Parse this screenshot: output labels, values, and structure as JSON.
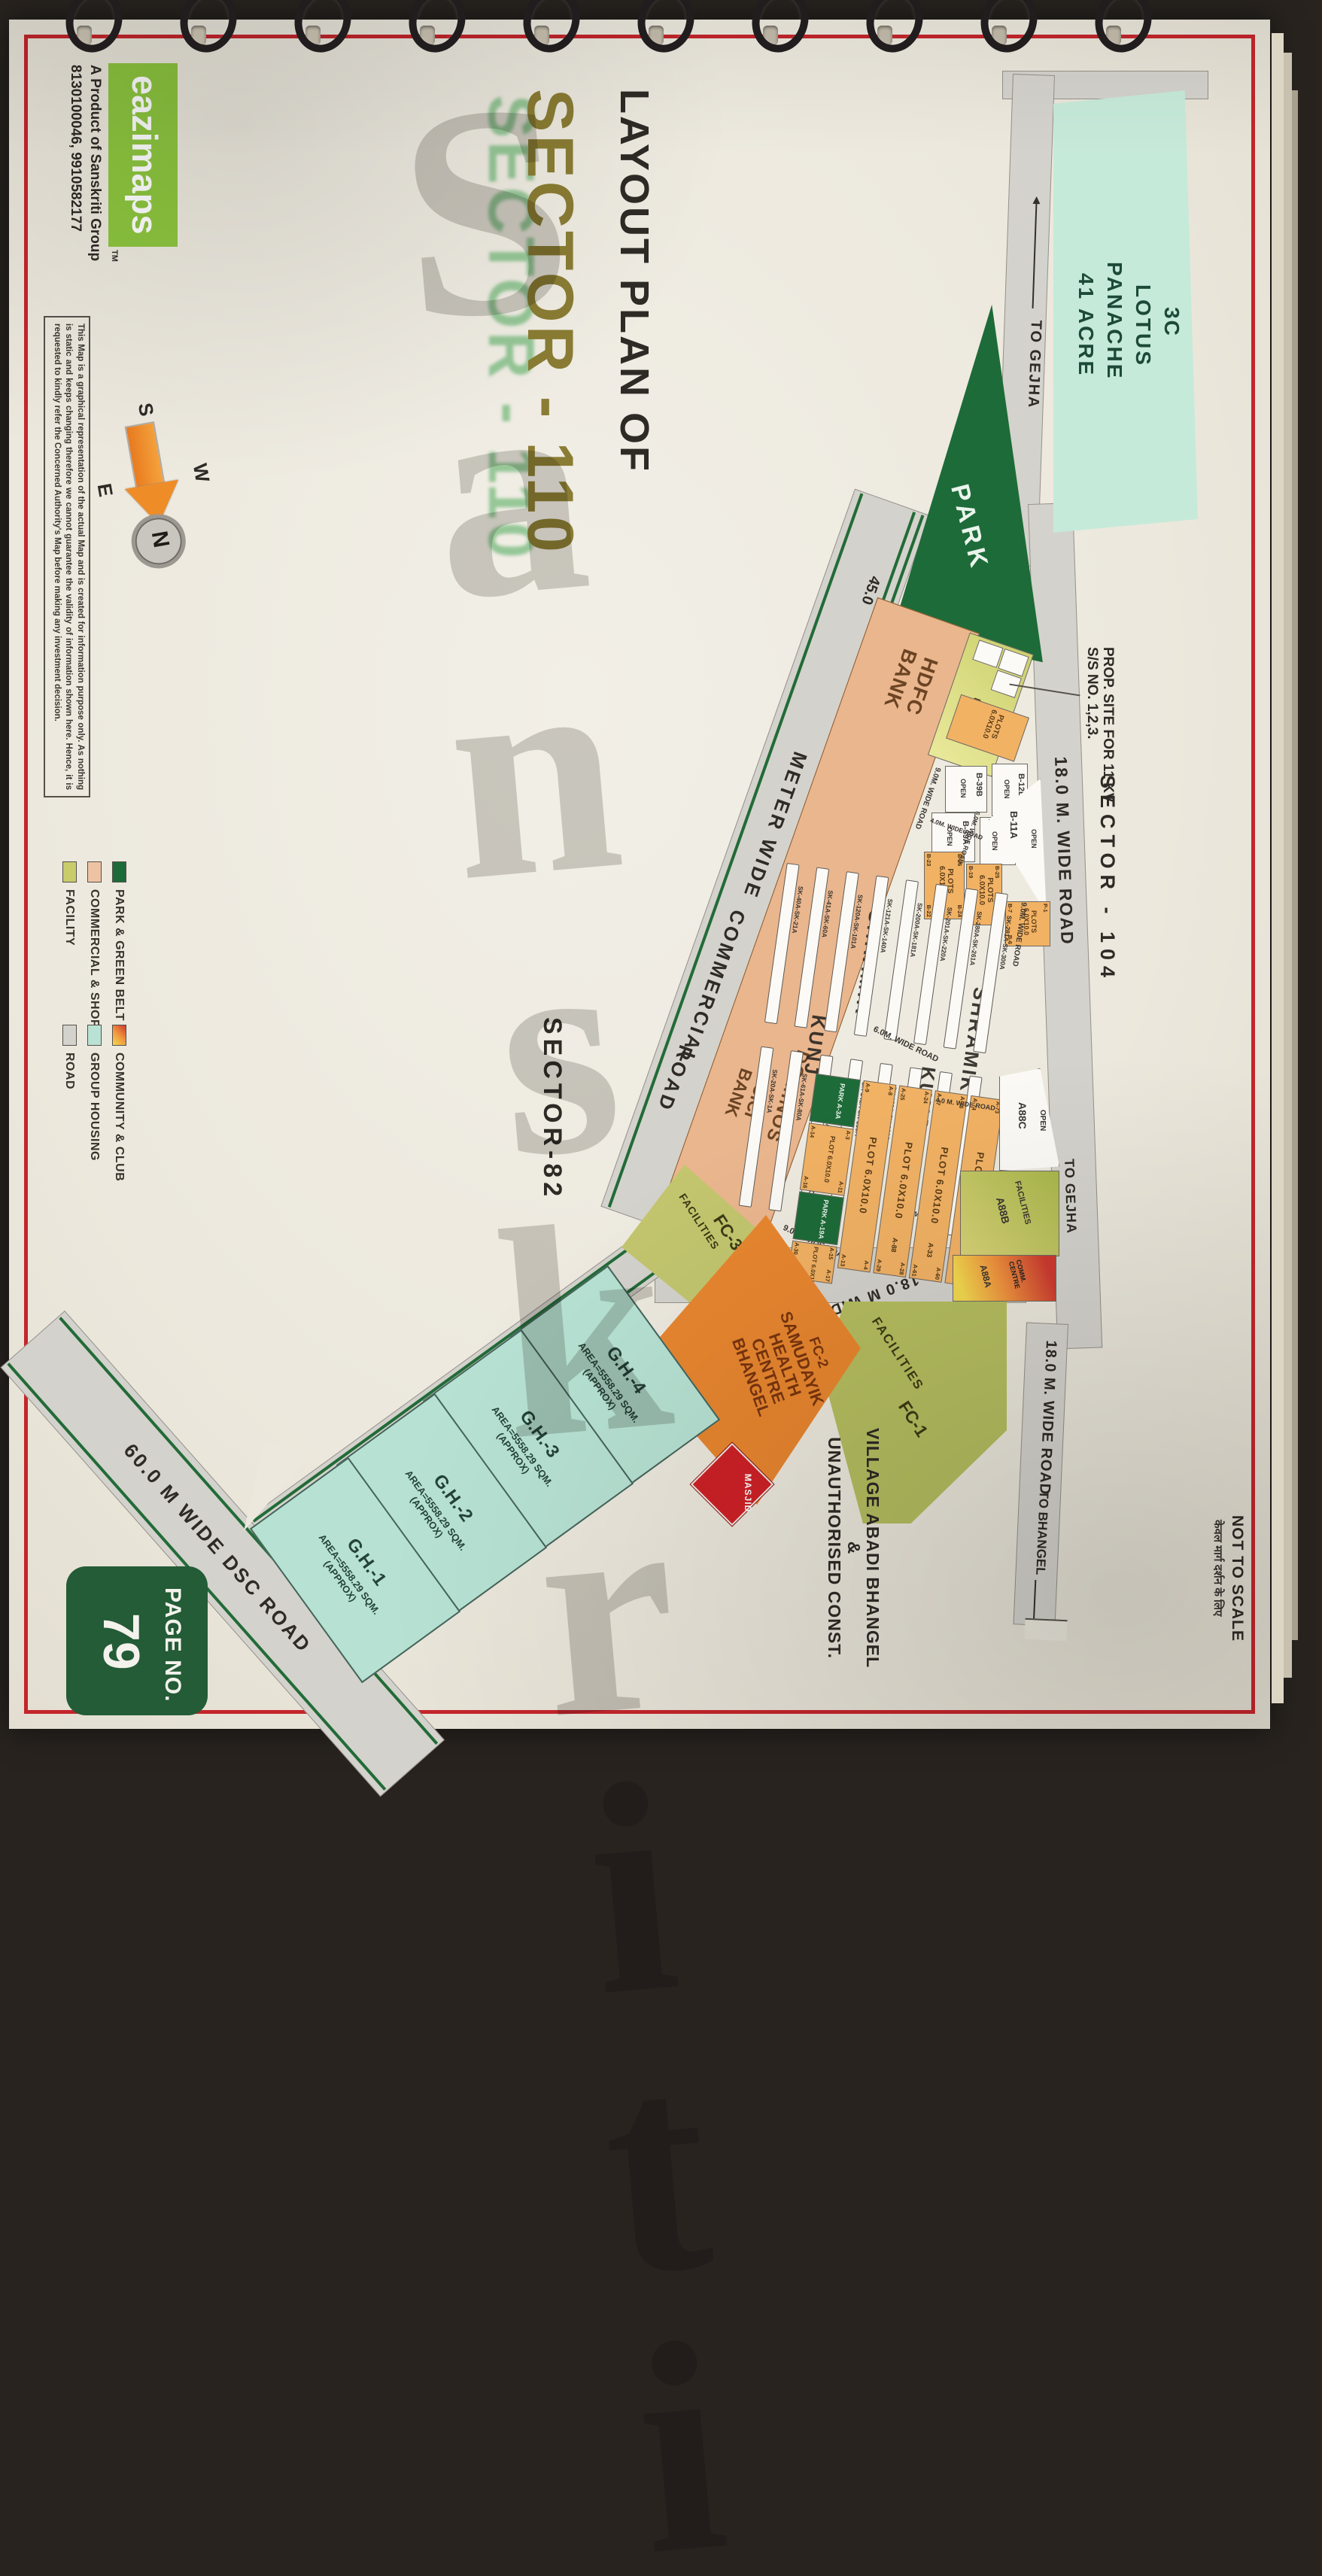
{
  "page_badge": {
    "label": "PAGE NO.",
    "number": "79"
  },
  "brand": {
    "logo": "eazimaps",
    "tm": "TM",
    "tagline": "A Product of Sanskriti Group",
    "phone": "8130100046, 9910582177",
    "logo_color": "#8dc63f"
  },
  "disclaimer": "This Map is a graphical representation of the actual Map and is created for information purpose only. As nothing is static and keeps changing therefore we cannot guarantee the validity of information shown here. Hence, it is requested to kindly refer the Concerned Authority's Map before making any investment decision.",
  "title": {
    "line1": "LAYOUT PLAN OF",
    "line2": "SECTOR - 110",
    "accent": "#8a7c33",
    "ghost": "#4aa857"
  },
  "watermark": "Sanskriti",
  "scale_note": {
    "en": "NOT TO SCALE",
    "hi": "केवल मार्ग दर्शन के लिए"
  },
  "compass": {
    "n": "N",
    "s": "S",
    "e": "E",
    "w": "W"
  },
  "legend": {
    "items": [
      {
        "label": "PARK & GREEN BELT",
        "color": "#1d6b38"
      },
      {
        "label": "COMMERCIAL & SHOPS",
        "color": "#eec3a4"
      },
      {
        "label": "FACILITY",
        "color": "#c9cc6b"
      },
      {
        "label": "COMMUNITY & CLUB",
        "color": "gradient:#cc3a30,#f0953e,#f3d94f"
      },
      {
        "label": "GROUP HOUSING",
        "color": "#b9e2d4"
      },
      {
        "label": "ROAD",
        "color": "#d4d2cc"
      }
    ]
  },
  "neighbors": {
    "lotus": {
      "l1": "3C",
      "l2": "LOTUS",
      "l3": "PANACHE",
      "l4": "41 ACRE"
    },
    "sector104": "SECTOR - 104",
    "sector82": "SECTOR-82",
    "prop_site": {
      "l1": "PROP. SITE FOR 11 KV",
      "l2": "S/S NO. 1,2,3."
    },
    "village": {
      "v1": "VILLAGE ABADI BHANGEL",
      "amp": "&",
      "v2": "UNAUTHORISED CONST."
    }
  },
  "roads": {
    "to_gejha_top": "TO GEJHA",
    "r18_upper": "18.0 M. WIDE ROAD",
    "to_gejha_right": "TO GEJHA",
    "r18_lower": "18.0 M. WIDE ROAD",
    "to_bhangel": "TO BHANGEL",
    "r45_num": "45.0",
    "r45_meter": "METER WIDE",
    "r45_comm": "COMMERCIAL",
    "r45_road": "ROAD",
    "r18_vert": "18.0 M WIDE ROAD",
    "dsc": "60.0 M WIDE DSC ROAD",
    "r9a": "9.0M. WIDE ROAD",
    "r9b": "9.0M. WIDE ROAD",
    "r9c": "9.0M WIDE ROAD",
    "r9d": "9.0M. WIDE ROAD",
    "r6a": "6.0M. WIDE ROAD",
    "r6b": "6.0M. WIDE ROAD",
    "r4a": "4.0M. WIDE ROAD",
    "r4b": "4.0M WIDE ROAD",
    "r4c": "4.0 M. WIDE ROAD"
  },
  "blocks": {
    "park": "PARK",
    "hdfc": {
      "l1": "HDFC",
      "l2": "BANK"
    },
    "dominos": "DOMINOS",
    "icici": {
      "l1": "ICICI",
      "l2": "BANK"
    },
    "fac": {
      "l1": "FAC.",
      "l2": "B-53A"
    },
    "plots53": {
      "l1": "PLOTS",
      "l2": "6.0X10.0"
    },
    "b12b": "B-12B",
    "b12c": "B-12C",
    "b39b": "B-39B",
    "b39a": "B-39A",
    "b11a": "B-11A",
    "open": "OPEN",
    "a88c": {
      "open": "OPEN",
      "name": "A88C"
    },
    "a88b": {
      "label": "FACILITIES",
      "name": "A88B"
    },
    "a88a": {
      "l1": "COMM.",
      "l2": "CENTRE",
      "name": "A88A"
    },
    "fc1": {
      "name": "FC-1",
      "label": "FACILITIES"
    },
    "fc3": {
      "name": "FC-3",
      "label": "FACILITIES"
    },
    "fc2": {
      "name": "FC-2",
      "l1": "SAMUDAYIK",
      "l2": "HEALTH",
      "l3": "CENTRE",
      "l4": "BHANGEL"
    },
    "masjid": "MASJID"
  },
  "plot_b": {
    "p1": {
      "c1": "PLOTS",
      "c2": "6.0X10.0",
      "tl": "B-26",
      "tr": "B-24",
      "bl": "B-23",
      "br": "B-22"
    },
    "p2": {
      "c1": "PLOTS",
      "c2": "6.0X10.0",
      "tl": "B-25",
      "tr": "B-12",
      "bl": "B-19",
      "br": "B-18"
    },
    "p3": {
      "c1": "PLOTS",
      "c2": "6.0X10.0",
      "tl": "P-1",
      "bl": "B-7",
      "br": "B-6"
    }
  },
  "shramik": {
    "big": {
      "s1": "SHRAMIK",
      "s2": "SHRAMIK",
      "k1": "KUNJ",
      "k2": "KUNJ"
    },
    "left_strips": [
      "SK-281A-SK-300A",
      "SK-280A-SK-261A",
      "SK-201A-SK-220A",
      "SK-200A-SK-181A",
      "SK-121A-SK-140A",
      "SK-120A-SK-101A",
      "SK-41A-SK-60A",
      "SK-40A-SK-21A"
    ],
    "right_strips": [
      "SK-301A-SK-320A",
      "SK-260-SK-241A",
      "SK-221A-SK-240A",
      "SK-180A-SK-161A",
      "SK-141A-SK-160A",
      "SK-100A-SK-81A",
      "SK-61A-SK-80A",
      "SK-20A-SK-1A"
    ]
  },
  "plot_grid": {
    "rows": [
      {
        "center": "PLOT 6.0X10.0",
        "tl": "A-73",
        "bl": "A-74",
        "tr": "A-75",
        "br": ""
      },
      {
        "center": "PLOT 6.0X10.0",
        "tl": "A-46",
        "bl": "A-47",
        "tr": "A-60",
        "br": "A-61",
        "end": "A-33"
      },
      {
        "center": "PLOT 6.0X10.0",
        "tl": "A-24",
        "bl": "A-25",
        "tr": "A-28",
        "br": "A-29",
        "end": "A-88"
      },
      {
        "center": "PLOT 6.0X10.0",
        "tl": "A-8",
        "bl": "A-9",
        "tr": "A-4",
        "br": "A-13",
        "end": ""
      }
    ],
    "parks": [
      "PARK A-3A",
      "PARK A-19A"
    ],
    "small": [
      {
        "center": "PLOT 6.0X10.0",
        "tl": "A-3",
        "bl": "A-14",
        "tr": "A-11",
        "br": "A-16"
      },
      {
        "center": "PLOT 6.0X10.0",
        "tl": "A-15",
        "bl": "A-30",
        "tr": "A-17",
        "br": "A-32"
      }
    ]
  },
  "gh": [
    {
      "name": "G.H.-4",
      "area": "AREA=5558.29 SQM.",
      "approx": "(APPROX)"
    },
    {
      "name": "G.H.-3",
      "area": "AREA=5558.29 SQM.",
      "approx": "(APPROX)"
    },
    {
      "name": "G.H.-2",
      "area": "AREA=5558.29 SQM.",
      "approx": "(APPROX)"
    },
    {
      "name": "G.H.-1",
      "area": "AREA=5558.29 SQM.",
      "approx": "(APPROX)"
    }
  ]
}
